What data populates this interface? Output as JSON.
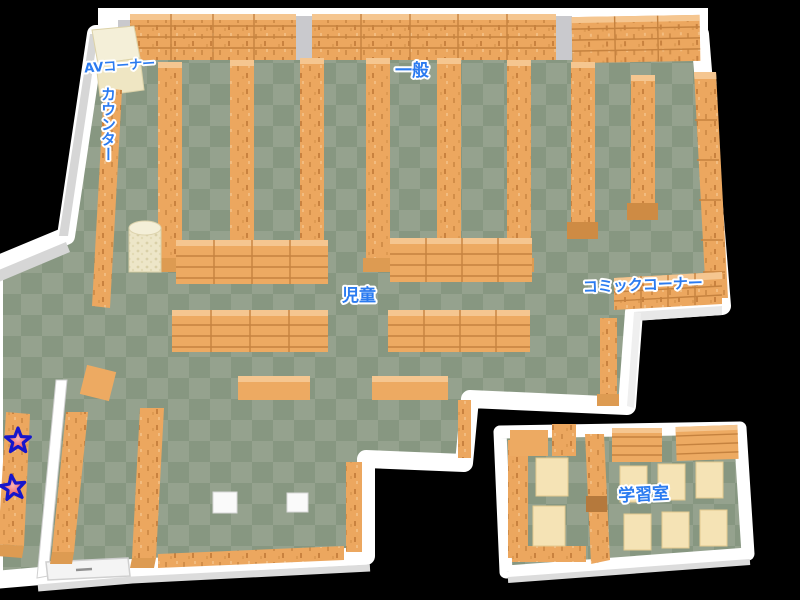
{
  "areas": {
    "av_corner": {
      "label": "AVコーナー"
    },
    "counter": {
      "label": "カウンター"
    },
    "general": {
      "label": "一般"
    },
    "children": {
      "label": "児童"
    },
    "comic_corner": {
      "label": "コミックコーナー"
    },
    "study_room": {
      "label": "学習室"
    }
  },
  "markers": {
    "star": {
      "icon": "star-icon",
      "count": 2
    }
  },
  "colors": {
    "background": "#000000",
    "floor_light": "#95A28E",
    "floor_dark": "#879781",
    "wall": "#FFFFFF",
    "wall_shadow": "#D6D6D6",
    "shelf": "#ECA75F",
    "shelf_line": "#C5823F",
    "shelf_top": "#F5C690",
    "shelf_cap": "#DD9B52",
    "av_shelf": "#F2ECD2",
    "desk": "#F5E3B5",
    "kiosk": "#EDE6C8",
    "label_text": "#2B7BF0",
    "label_outline": "#FFFFFF",
    "star_fill": "#F07070",
    "star_outline": "#1616CC"
  }
}
